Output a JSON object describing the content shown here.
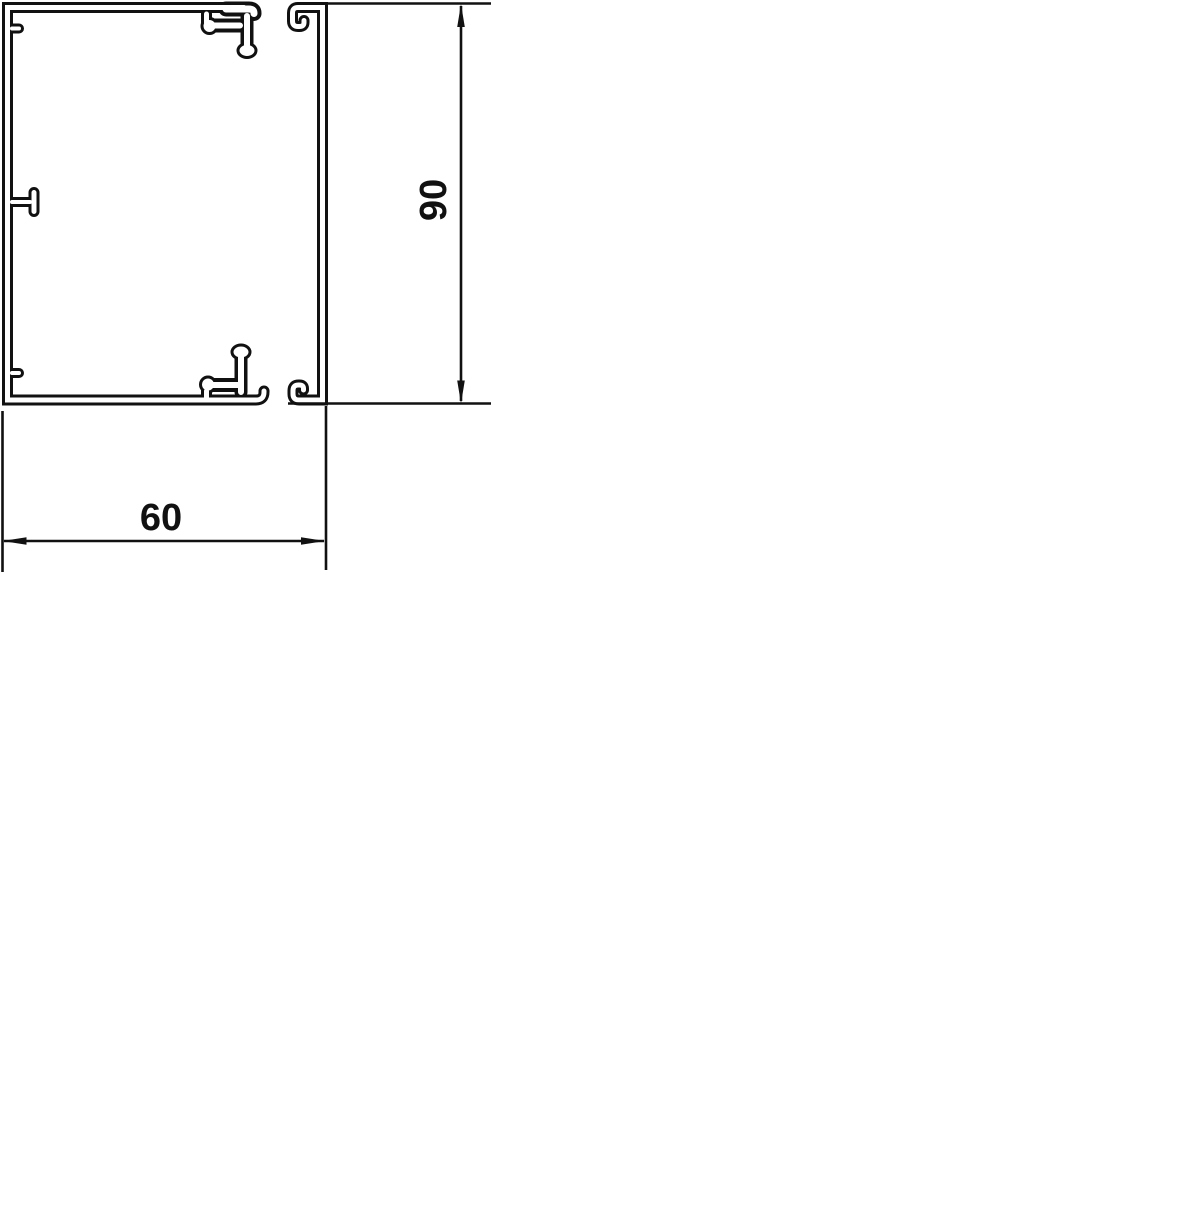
{
  "drawing": {
    "line_color": "#111111",
    "background_color": "#ffffff",
    "dimensions": {
      "width_label": "60",
      "height_label": "90"
    }
  }
}
